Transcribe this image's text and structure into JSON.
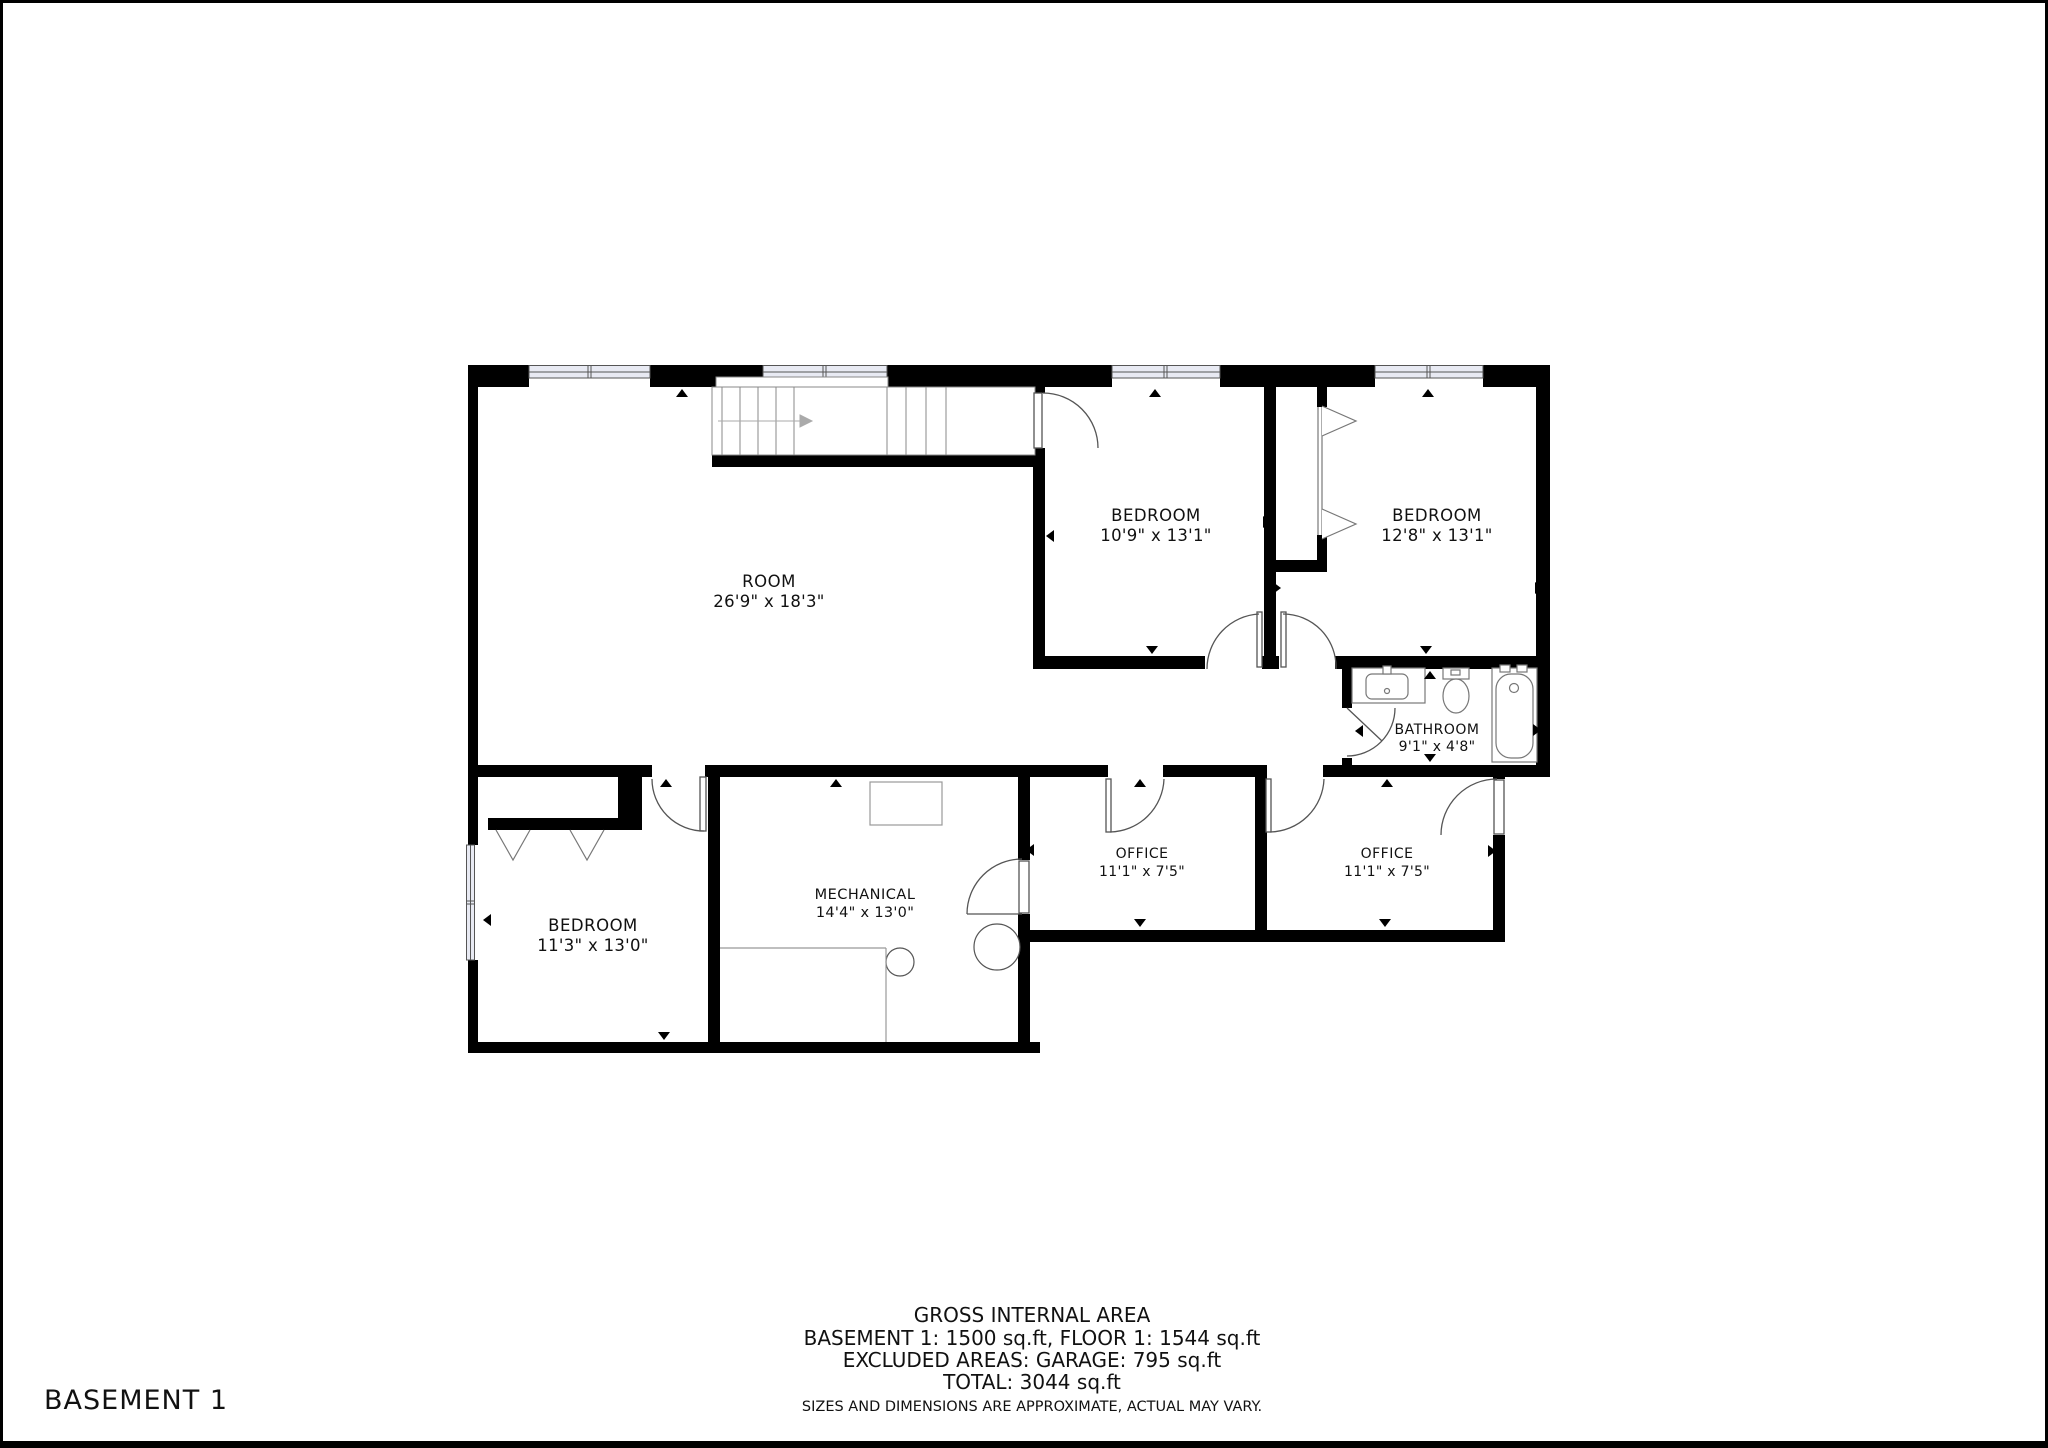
{
  "floor_label": "BASEMENT 1",
  "rooms": [
    {
      "name": "ROOM",
      "dims": "26'9\" x 18'3\""
    },
    {
      "name": "BEDROOM",
      "dims": "10'9\" x 13'1\""
    },
    {
      "name": "BEDROOM",
      "dims": "12'8\" x 13'1\""
    },
    {
      "name": "BATHROOM",
      "dims": "9'1\" x 4'8\""
    },
    {
      "name": "BEDROOM",
      "dims": "11'3\" x 13'0\""
    },
    {
      "name": "MECHANICAL",
      "dims": "14'4\" x 13'0\""
    },
    {
      "name": "OFFICE",
      "dims": "11'1\" x 7'5\""
    },
    {
      "name": "OFFICE",
      "dims": "11'1\" x 7'5\""
    }
  ],
  "footer": {
    "line1": "GROSS INTERNAL AREA",
    "line2": "BASEMENT 1: 1500 sq.ft, FLOOR 1: 1544 sq.ft",
    "line3": "EXCLUDED AREAS: GARAGE: 795 sq.ft",
    "line4": "TOTAL: 3044 sq.ft",
    "disclaimer": "SIZES AND DIMENSIONS ARE APPROXIMATE, ACTUAL MAY VARY."
  },
  "colors": {
    "wall": "#000000",
    "label_text": "#111111",
    "muted_text": "#9a9a9a",
    "window_glazing": "#e8eaf3",
    "fixture_line": "#888888"
  }
}
